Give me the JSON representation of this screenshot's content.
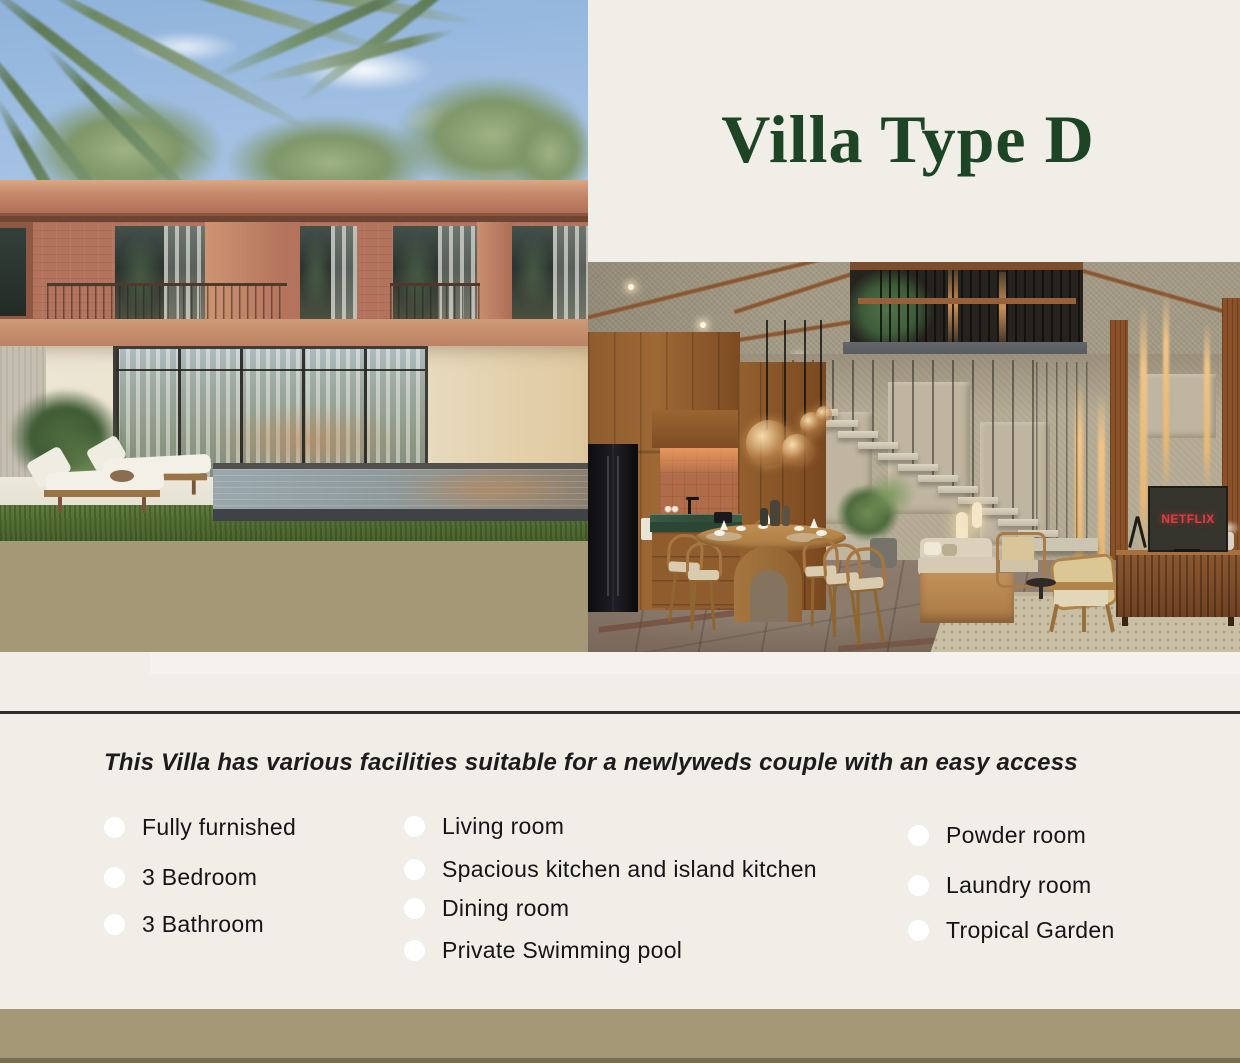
{
  "header": {
    "title": "Villa Type D"
  },
  "facilities": {
    "intro": "This Villa has various facilities suitable for a newlyweds couple with an easy access",
    "columns": [
      {
        "items": [
          "Fully furnished",
          "3 Bedroom",
          "3 Bathroom"
        ]
      },
      {
        "items": [
          "Living room",
          "Spacious kitchen and island kitchen",
          "Dining room",
          "Private Swimming pool"
        ]
      },
      {
        "items": [
          "Powder room",
          "Laundry room",
          "Tropical Garden"
        ]
      }
    ]
  },
  "interior": {
    "tv_text": "NETFLIX"
  },
  "colors": {
    "title_green": "#1D4425",
    "cream_background": "#F1EEE8",
    "tan_bar": "#A49877",
    "divider": "#2F2E29",
    "netflix_red": "#E23C40",
    "bullet": "#FFFFFF",
    "list_text": "#151515"
  }
}
